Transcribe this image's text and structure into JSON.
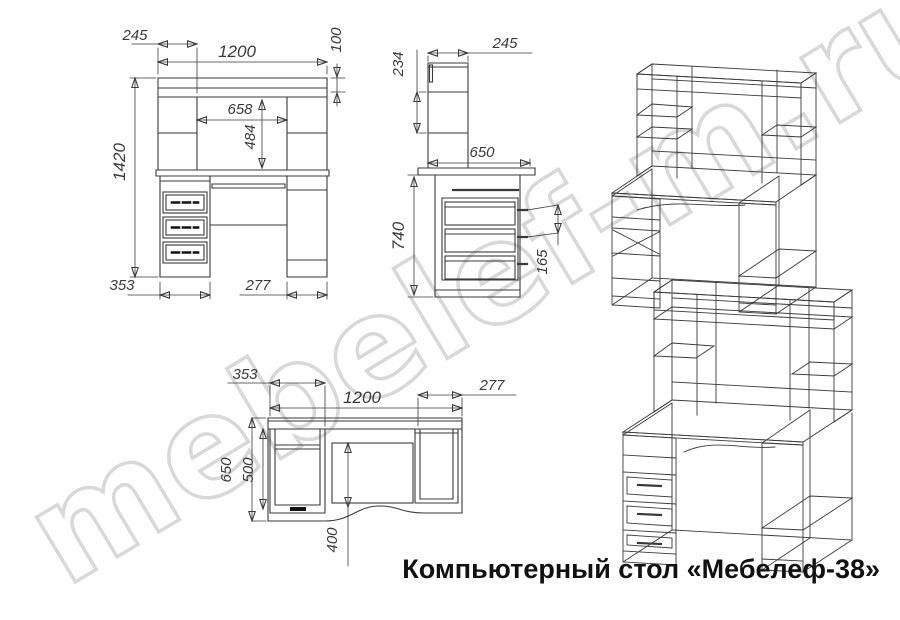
{
  "title": "Компьютерный стол «Мебелеф-38»",
  "watermark": "mebelef-m.ru",
  "drawing_color": "#3a3a3a",
  "watermark_color": "#d8d8d8",
  "views": {
    "front": {
      "dims": {
        "w245": "245",
        "w1200": "1200",
        "h100": "100",
        "w658": "658",
        "h484": "484",
        "h1420": "1420",
        "w353": "353",
        "w277": "277"
      }
    },
    "side": {
      "dims": {
        "h234": "234",
        "w245": "245",
        "w650": "650",
        "h740": "740",
        "p165": "165"
      }
    },
    "top": {
      "dims": {
        "w353": "353",
        "w1200": "1200",
        "w277": "277",
        "d650": "650",
        "d500": "500",
        "d400": "400"
      }
    }
  }
}
